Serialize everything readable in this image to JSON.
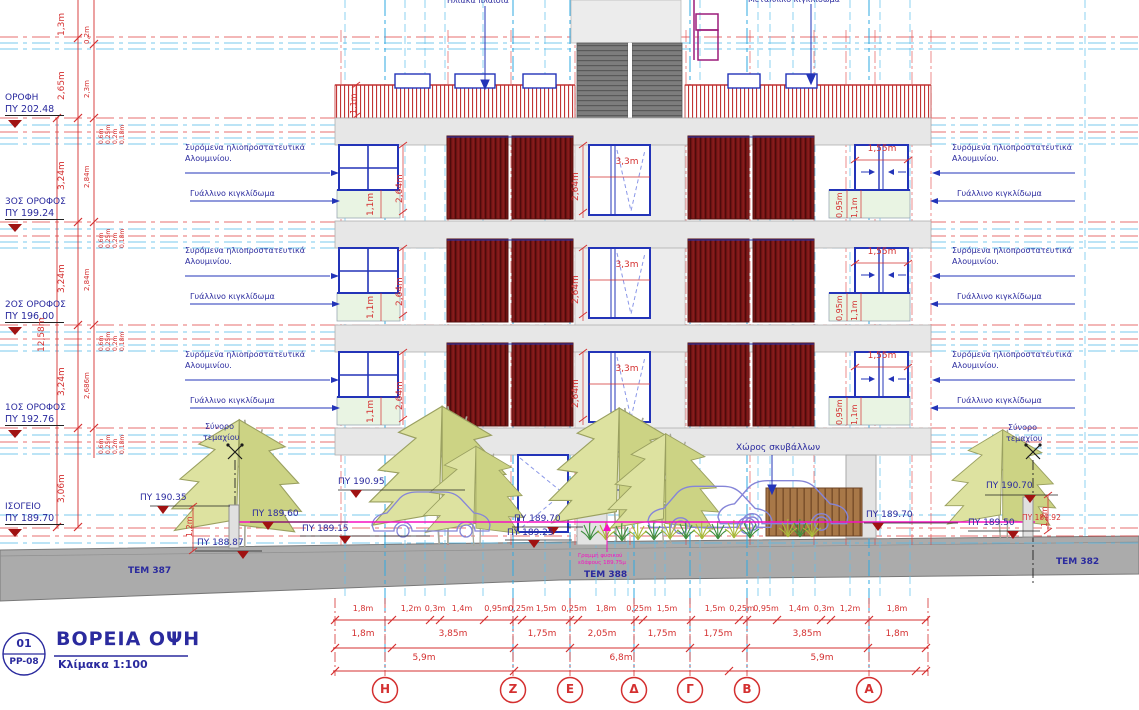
{
  "title_block": {
    "number": "01",
    "code": "PP-08",
    "title": "ΒΟΡΕΙΑ ΟΨΗ",
    "scale": "Κλίμακα 1:100"
  },
  "levels": [
    {
      "name": "ΟΡΟΦΗ",
      "elev": "ΠΥ 202.48"
    },
    {
      "name": "3ΟΣ ΟΡΟΦΟΣ",
      "elev": "ΠΥ 199.24"
    },
    {
      "name": "2ΟΣ ΟΡΟΦΟΣ",
      "elev": "ΠΥ 196.00"
    },
    {
      "name": "1ΟΣ ΟΡΟΦΟΣ",
      "elev": "ΠΥ 192.76"
    },
    {
      "name": "ΙΣΟΓΕΙΟ",
      "elev": "ΠΥ 189.70"
    }
  ],
  "left_dims": {
    "d1": "1,3m",
    "d2": "0,2m",
    "d3": "2,65m",
    "d4": "2,3m",
    "d5": "3,24m",
    "d6": "2,84m",
    "d7": "2,686m",
    "d8": "3,06m",
    "total": "12,58m",
    "slab": [
      "0,6m",
      "0,25m",
      "0,2m",
      "0,18m"
    ]
  },
  "ann": {
    "solar_panels": "Ηλιακά πλαίσια",
    "metal_railing": "Μεταλλικό κιγκλίδωμα",
    "sliding_1": "Συρόμενα ηλιοπροστατευτικά",
    "sliding_2": "Αλουμινίου.",
    "glass_railing": "Γυάλλινο κιγκλίδωμα",
    "garbage_area": "Χώρος σκυβάλλων",
    "boundary_1": "Σύνορο",
    "boundary_2": "τεμαχίου",
    "ground_note_1": "Γραμμή φυσικού",
    "ground_note_2": "εδάφους 189.75μ"
  },
  "fd": {
    "center_w": "3,3m",
    "center_h": "2,64m",
    "rail_h": "1,1m",
    "rail_h_small": "0,95m",
    "right_w": "1,55m",
    "roof_rail": "1,1m",
    "yard": "1,2m"
  },
  "spot": {
    "s1": "ΠΥ 190.95",
    "s2": "ΠΥ 190.35",
    "s3": "ΠΥ 189.60",
    "s4": "ΠΥ 189.15",
    "s5": "ΠΥ 188.87",
    "s6": "ΠΥ 189.70",
    "s7": "ΠΥ 189.25",
    "s8": "ΠΥ 189.70",
    "s9": "ΠΥ 189.50",
    "s10": "ΠΥ 190.70",
    "s11": "ΠΥ 189.92"
  },
  "plots": {
    "p1": "ΤΕΜ 387",
    "p2": "ΤΕΜ 388",
    "p3": "ΤΕΜ 382"
  },
  "axes": [
    "Η",
    "Ζ",
    "Ε",
    "Δ",
    "Γ",
    "Β",
    "Α"
  ],
  "bottom": {
    "row1": [
      "1,8m",
      "1,2m",
      "0,3m",
      "1,4m",
      "0,95m",
      "0,25m",
      "1,5m",
      "0,25m",
      "1,8m",
      "0,25m",
      "1,5m",
      "1,5m",
      "0,25m",
      "0,95m",
      "1,4m",
      "0,3m",
      "1,2m",
      "1,8m"
    ],
    "row2": [
      "1,8m",
      "3,85m",
      "1,75m",
      "2,05m",
      "1,75m",
      "1,75m",
      "3,85m",
      "1,8m"
    ],
    "row3": [
      "5,9m",
      "6,8m",
      "5,9m"
    ]
  },
  "colors": {
    "dim_red": "#d43030",
    "grid_cyan": "#3fb0e4",
    "navy": "#2a2a9e",
    "shutter": "#731313",
    "magenta": "#f511c2",
    "glass": "#e9f4e3",
    "ground": "#ababab"
  }
}
